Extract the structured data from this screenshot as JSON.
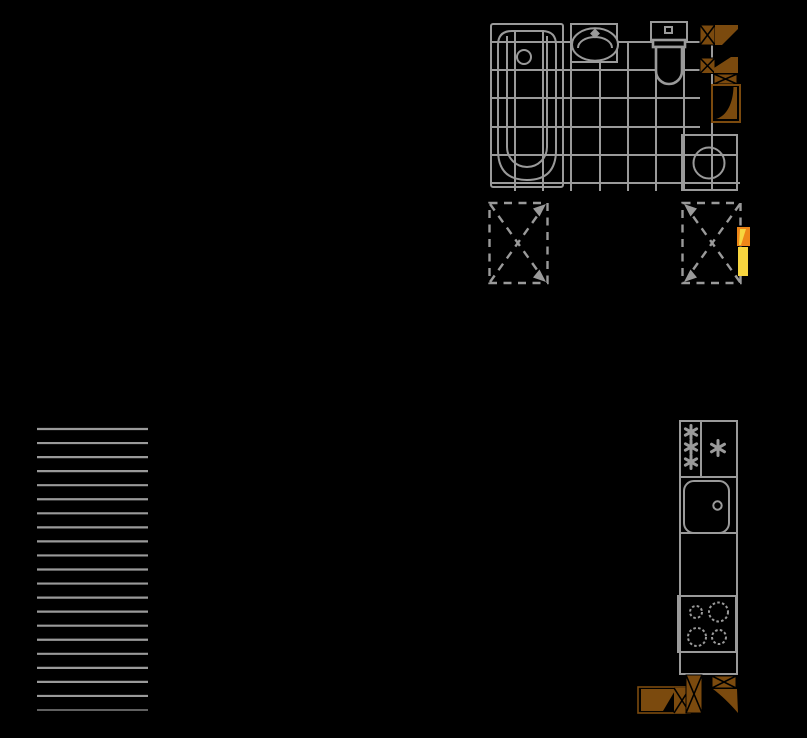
{
  "scene": {
    "kind": "floor-plan-drawing",
    "background": "#000000"
  },
  "palette": {
    "background": "#000000",
    "line": "#9a9a9a",
    "wood": "#7b4a0e",
    "orange": "#ee8618",
    "yellow": "#f7d53f"
  },
  "bathroom": {
    "tile_grid": {
      "vertical_lines": 8,
      "horizontal_rows": 6,
      "spacing_px": 28
    },
    "fixtures": [
      {
        "name": "bathtub"
      },
      {
        "name": "washbasin"
      },
      {
        "name": "toilet"
      },
      {
        "name": "washing-machine"
      }
    ],
    "door_symbols": {
      "count": 2,
      "color": "#7b4a0e",
      "post_style": "crossed-box"
    }
  },
  "vent_shafts": {
    "count": 2,
    "style": "dashed rectangle with dashed X diagonals and corner arrowheads",
    "left_shaft_arrows": [
      "top-right",
      "bottom-right"
    ],
    "right_shaft_arrows": [
      "top-left",
      "bottom-left"
    ]
  },
  "radiator": {
    "segments": 2,
    "colors": [
      "#ee8618",
      "#f7d53f"
    ]
  },
  "staircase": {
    "treads": 21,
    "x1": 37,
    "x2": 148,
    "y_start": 429,
    "y_spacing": 14.05
  },
  "kitchen": {
    "fridge_freezer": {
      "freezer_snowflakes": 3,
      "fridge_snowflakes": 1
    },
    "sink_units": 1,
    "stove_burners": 4,
    "door_symbols": {
      "count": 3,
      "color": "#7b4a0e"
    }
  }
}
